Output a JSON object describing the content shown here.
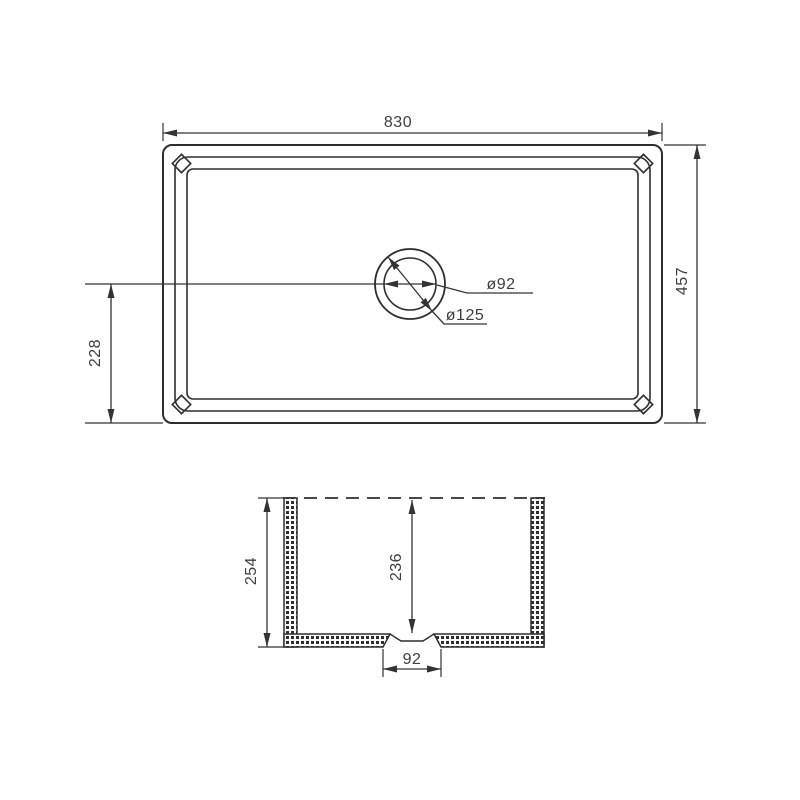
{
  "drawing": {
    "type": "technical-drawing-sink",
    "colors": {
      "line": "#2e2e2e",
      "text": "#3d3d3d",
      "background": "#ffffff"
    },
    "top_view": {
      "width": "830",
      "height": "457",
      "drain_center_offset": "228",
      "drain_inner_diameter": "ø92",
      "drain_outer_diameter": "ø125"
    },
    "section_view": {
      "outer_depth": "254",
      "inner_depth": "236",
      "drain_width": "92"
    }
  }
}
